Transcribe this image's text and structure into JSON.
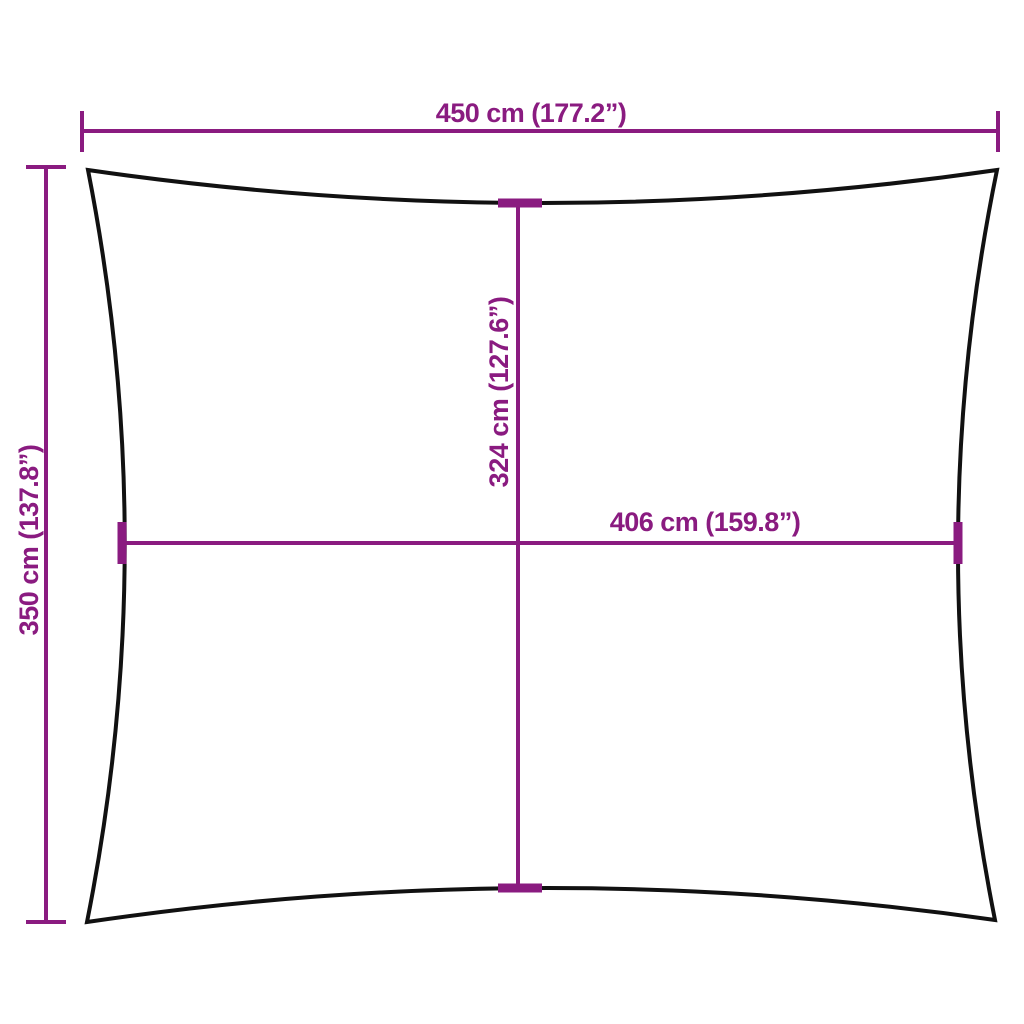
{
  "diagram": {
    "kind": "product-dimension-diagram",
    "subject": "rectangular shade sail with concave edges",
    "labels": {
      "top_width": "450 cm (177.2”)",
      "left_height": "350 cm (137.8”)",
      "inner_height": "324 cm (127.6”)",
      "inner_width": "406 cm (159.8”)"
    },
    "colors": {
      "dimension_accent": "#8a1b80",
      "outline": "#111111",
      "background": "#ffffff"
    }
  }
}
